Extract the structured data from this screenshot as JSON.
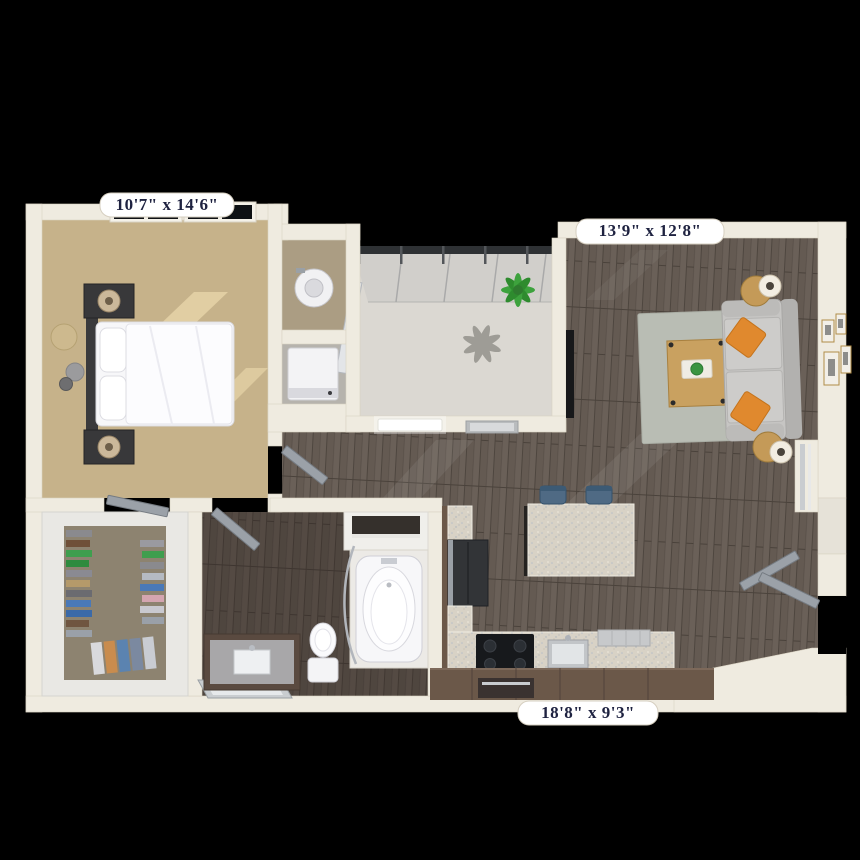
{
  "scene": {
    "description": "3D rendered one-bedroom apartment floor plan, top-down view on black background"
  },
  "labels": {
    "bedroom": "10'7\" x 14'6\"",
    "living_room": "13'9\" x 12'8\"",
    "kitchen_living": "18'8\" x 9'3\""
  },
  "colors": {
    "background": "#000000",
    "walls": "#efebe0",
    "label_pill": "#ffffff",
    "label_text": "#1e2240",
    "bedroom_carpet": "#c6b28a",
    "wood_floor": "#6a6058",
    "balcony_concrete": "#dbd8d2",
    "granite_counter": "#d8d2c6",
    "cabinet_brown": "#6b5849",
    "sofa_gray": "#c6c5c3",
    "pillow_orange": "#e0892e",
    "stool_blue": "#4f6a84",
    "door_gray": "#9ba1a8",
    "plant_green": "#3da23d",
    "rug_gray": "#b9bdb4",
    "closet_carpet": "#8d8370"
  }
}
